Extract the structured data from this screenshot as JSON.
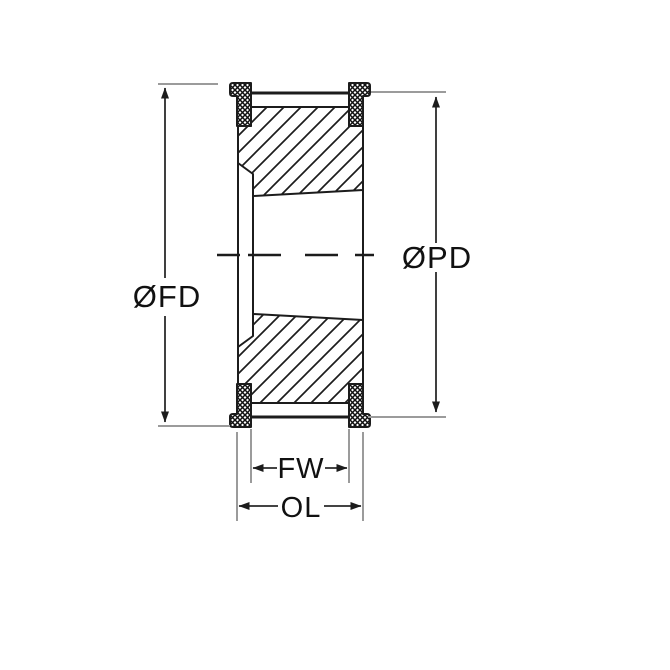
{
  "diagram": {
    "type": "technical-drawing",
    "subject": "timing-pulley-cross-section",
    "dimension_labels": {
      "flange_diameter": "ØFD",
      "pitch_diameter": "ØPD",
      "face_width": "FW",
      "overall_length": "OL"
    },
    "colors": {
      "line": "#1c1c1c",
      "extension_line": "#9b9b9b",
      "background": "#ffffff"
    }
  }
}
